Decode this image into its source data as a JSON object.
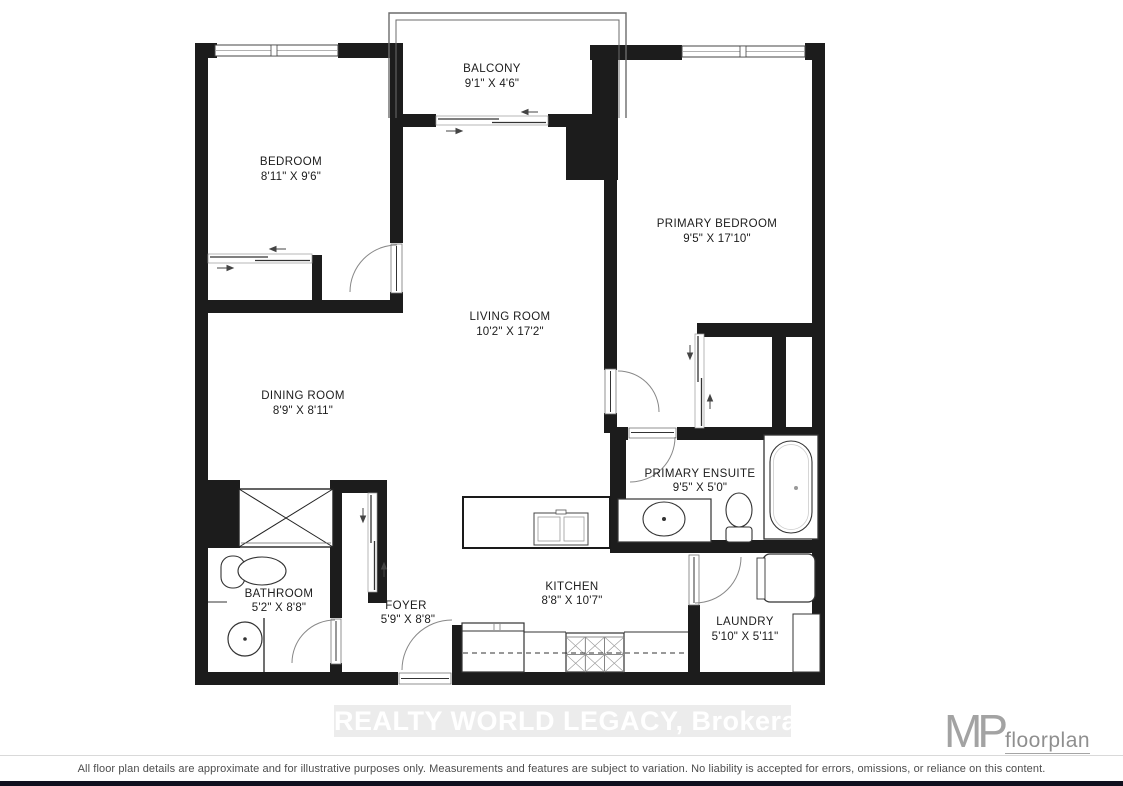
{
  "floorplan": {
    "rooms": [
      {
        "name": "BALCONY",
        "dims": "9'1\" X 4'6\""
      },
      {
        "name": "BEDROOM",
        "dims": "8'11\" X 9'6\""
      },
      {
        "name": "PRIMARY BEDROOM",
        "dims": "9'5\" X 17'10\""
      },
      {
        "name": "LIVING ROOM",
        "dims": "10'2\" X 17'2\""
      },
      {
        "name": "DINING ROOM",
        "dims": "8'9\" X 8'11\""
      },
      {
        "name": "PRIMARY ENSUITE",
        "dims": "9'5\" X 5'0\""
      },
      {
        "name": "BATHROOM",
        "dims": "5'2\" X 8'8\""
      },
      {
        "name": "FOYER",
        "dims": "5'9\" X 8'8\""
      },
      {
        "name": "KITCHEN",
        "dims": "8'8\" X 10'7\""
      },
      {
        "name": "LAUNDRY",
        "dims": "5'10\" X 5'11\""
      }
    ],
    "watermark": "REALTY WORLD LEGACY, Brokerage",
    "logo": {
      "mp": "MP",
      "text": "floorplan"
    },
    "disclaimer": "All floor plan details are approximate and for illustrative purposes only. Measurements and features are subject to variation. No liability is accepted for errors, omissions, or reliance on this content.",
    "colors": {
      "wall": "#1c1c1c",
      "watermark_bg": "#ececec",
      "watermark_text": "#ffffff",
      "logo_gray": "#9a9a9a",
      "disclaimer_text": "#4d4d4d",
      "bottom_bar": "#10101e"
    }
  }
}
